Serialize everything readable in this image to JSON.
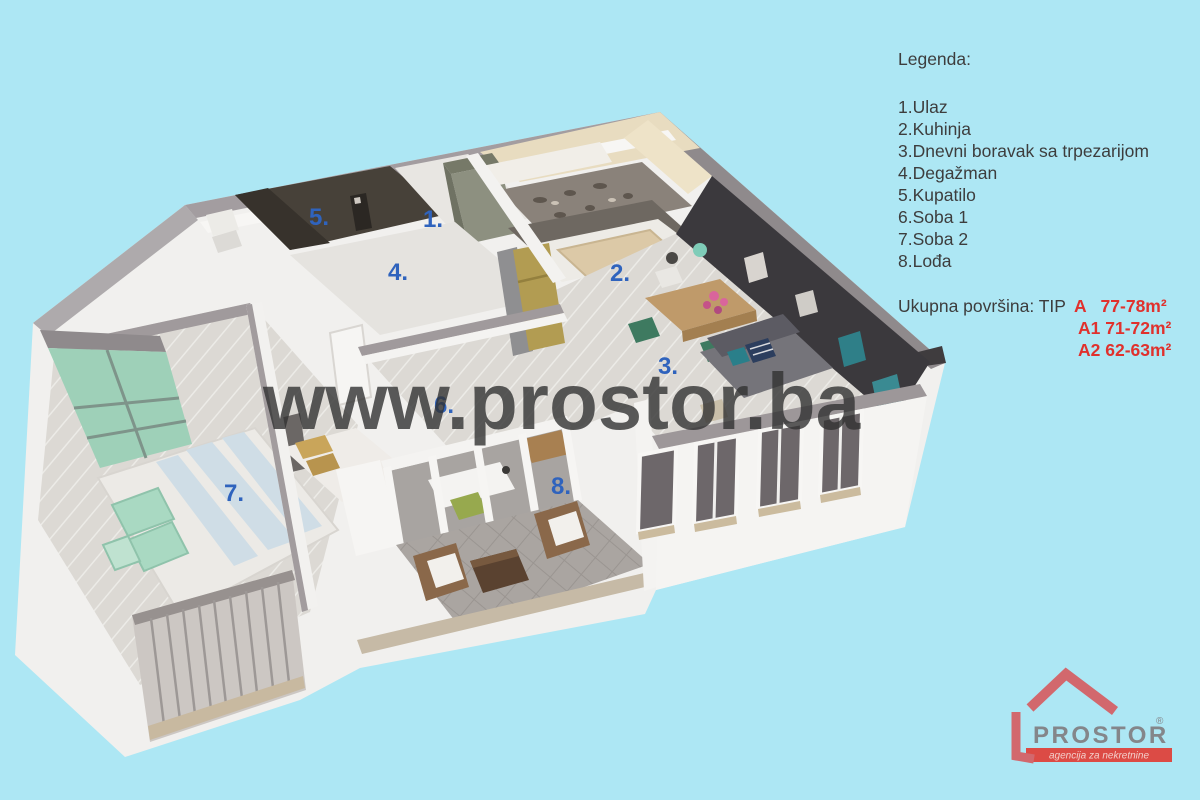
{
  "background_color": "#ade7f4",
  "legend": {
    "title": "Legenda:",
    "items": [
      "1.Ulaz",
      "2.Kuhinja",
      "3.Dnevni boravak sa trpezarijom",
      "4.Degažman",
      "5.Kupatilo",
      "6.Soba 1",
      "7.Soba 2",
      "8.Lođa"
    ]
  },
  "area": {
    "label": "Ukupna površina: TIP",
    "tip_a": "A   77-78m²",
    "tip_a1": "A1 71-72m²",
    "tip_a2": "A2 62-63m²",
    "text_color": "#e0312d"
  },
  "watermark": {
    "text": "www.prostor.ba"
  },
  "plan": {
    "number_color": "#2f63bd",
    "numbers": [
      "1.",
      "2.",
      "3.",
      "4.",
      "5.",
      "6.",
      "7.",
      "8."
    ]
  },
  "logo": {
    "name": "PROSTOR",
    "registered": "®",
    "tagline": "agencija za nekretnine",
    "house_color": "#d2686d",
    "banner_color": "#dc4b45",
    "name_color": "#84868a"
  }
}
